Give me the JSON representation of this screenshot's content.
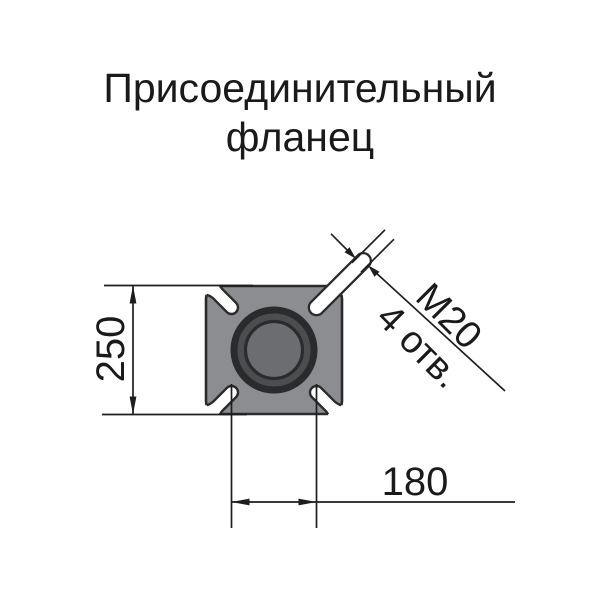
{
  "title": {
    "line1": "Присоединительный",
    "line2": "фланец"
  },
  "drawing": {
    "view": "flange-top-view",
    "dimensions": {
      "flange_size": {
        "value": "250"
      },
      "bolt_spacing": {
        "value": "180"
      },
      "bolt_hole": {
        "thread": "М20",
        "count": "4 отв."
      }
    }
  },
  "colors": {
    "background": "#ffffff",
    "text": "#1a1a1a",
    "line": "#1e1e1e",
    "outline": "#2b2b2d",
    "flange_body": "#8b8d90",
    "ring": "#4b4d4f",
    "bore": "#6b6d71",
    "cutout": "#ffffff"
  }
}
